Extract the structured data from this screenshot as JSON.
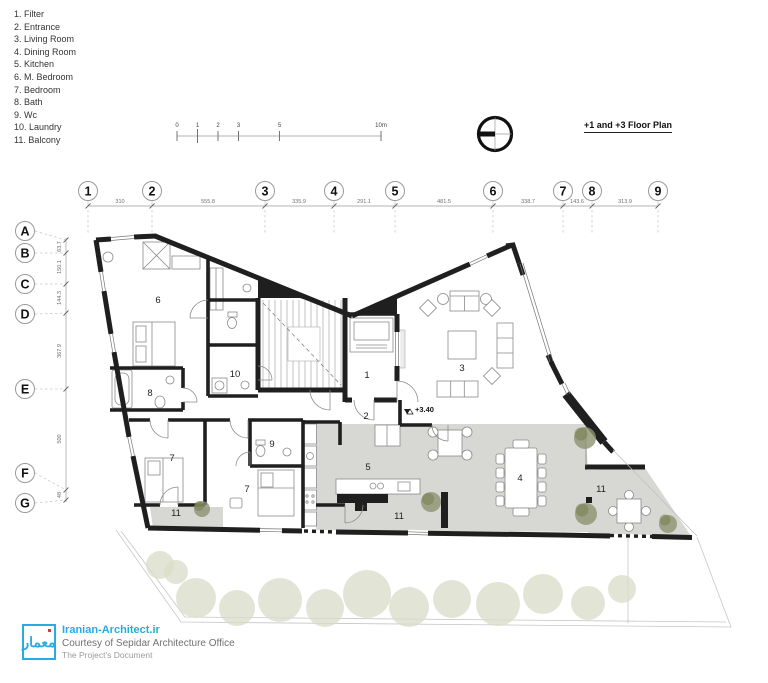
{
  "legend": {
    "items": [
      "1. Filter",
      "2. Entrance",
      "3. Living Room",
      "4. Dining Room",
      "5. Kitchen",
      "6. M. Bedroom",
      "7. Bedroom",
      "8. Bath",
      "9. Wc",
      "10. Laundry",
      "11. Balcony"
    ]
  },
  "header": {
    "title": "+1 and +3 Floor Plan"
  },
  "scale_bar": {
    "labels": [
      "0",
      "1",
      "2",
      "3",
      "5",
      "10m"
    ]
  },
  "grid": {
    "columns": [
      "1",
      "2",
      "3",
      "4",
      "5",
      "6",
      "7",
      "8",
      "9"
    ],
    "column_dims": [
      "310",
      "555.8",
      "335.9",
      "291.1",
      "481.5",
      "338.7",
      "143.6",
      "313.9"
    ],
    "rows": [
      "A",
      "B",
      "C",
      "D",
      "E",
      "F",
      "G"
    ],
    "row_dims": [
      "63.7",
      "150.1",
      "144.3",
      "367.9",
      "500",
      "48"
    ]
  },
  "plan": {
    "level_marker": "+3.40",
    "rooms": {
      "filter": "1",
      "entrance": "2",
      "living": "3",
      "dining": "4",
      "kitchen": "5",
      "m_bedroom": "6",
      "bedroom_a": "7",
      "bedroom_b": "7",
      "bath": "8",
      "wc": "9",
      "laundry": "10",
      "balcony_left": "11",
      "balcony_center": "11",
      "balcony_right": "11"
    },
    "colors": {
      "wall": "#1f1f1f",
      "floor_gray": "#d7d7d4",
      "tree": "#8d9270",
      "accent": "#29abe2"
    }
  },
  "watermark": {
    "logo_text": "معمار",
    "site": "Iranian-Architect.ir",
    "courtesy": "Courtesy of Sepidar Architecture Office",
    "document": "The Project's Document"
  }
}
